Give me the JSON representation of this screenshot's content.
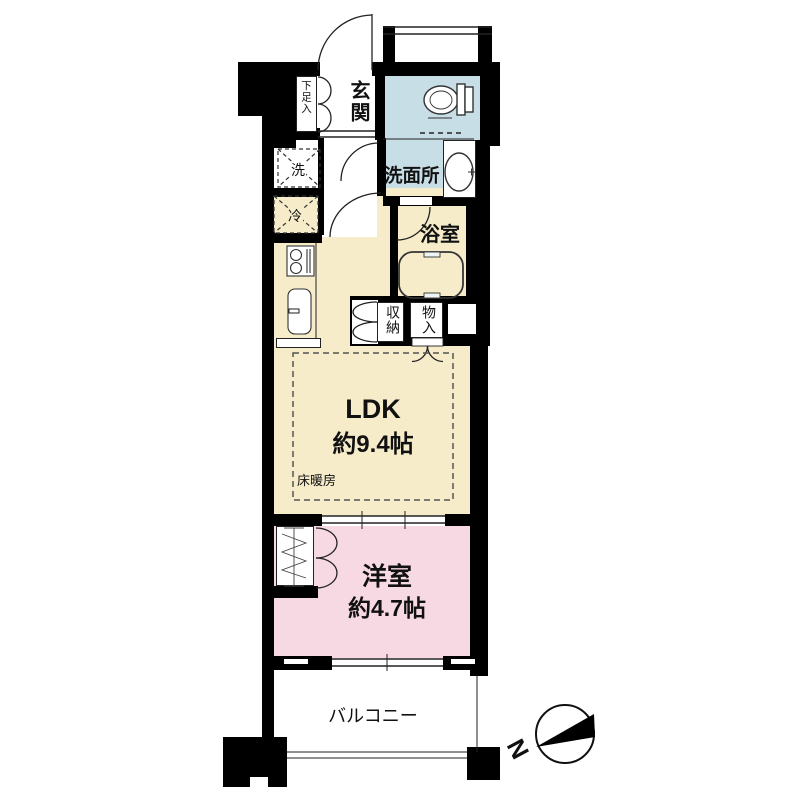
{
  "plan": {
    "entrance": "玄関",
    "shoe_cabinet": "下足入",
    "washer": "洗",
    "refrigerator": "冷",
    "washroom": "洗面所",
    "bathroom": "浴室",
    "storage": "収納",
    "closet": "物入",
    "ldk_label": "LDK",
    "ldk_size": "約9.4帖",
    "floor_heating": "床暖房",
    "western_label": "洋室",
    "western_size": "約4.7帖",
    "balcony": "バルコニー",
    "compass_north": "N"
  },
  "colors": {
    "wall": "#000000",
    "ldk_floor": "#f6ecca",
    "bedroom_floor": "#f7d9e4",
    "wet_area_floor": "#c8dee6",
    "line": "#222222"
  }
}
